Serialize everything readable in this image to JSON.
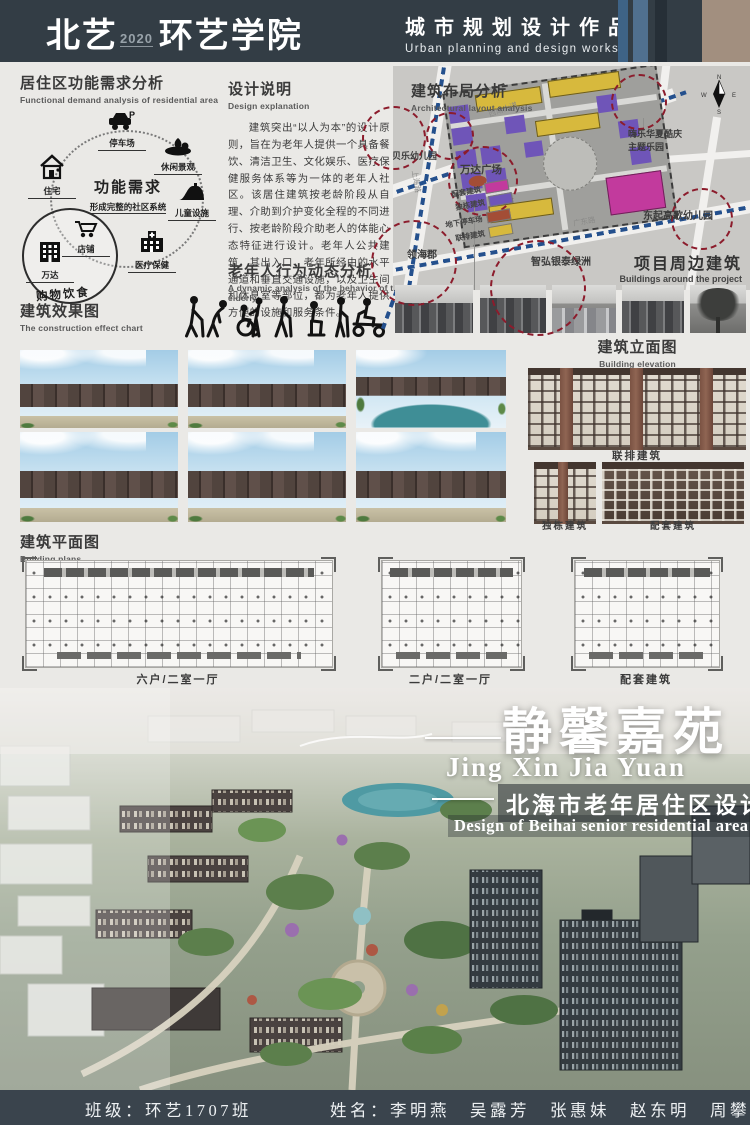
{
  "header": {
    "brand": "北艺",
    "year": "2020",
    "school": "环艺学院",
    "title_cn": "城市规划设计作品",
    "title_en": "Urban planning and design works"
  },
  "demand": {
    "title_cn": "居住区功能需求分析",
    "title_en": "Functional demand analysis of residential area",
    "center": "功能需求",
    "center_sub": "形成完整的社区系统",
    "nodes": [
      "停车场",
      "休闲景观",
      "儿童设施",
      "医疗保健",
      "住宅"
    ],
    "shop": {
      "title": "购物饮食",
      "wanda": "万达",
      "store": "店铺"
    }
  },
  "design": {
    "title_cn": "设计说明",
    "title_en": "Design explanation",
    "body": "建筑突出“以人为本”的设计原则，旨在为老年人提供一个具备餐饮、清洁卫生、文化娱乐、医疗保健服务体系等为一体的老年人社区。该居住建筑按老龄阶段从自理、介助到介护变化全程的不同进行、按老龄阶段介助老人的体能心态特征进行设计。老年人公共建筑，其出入口、老年所经由的水平通道和垂直交通设施，以及卫生间和休息室等部位，都为老年人提供方便的设施和服务条件。"
  },
  "elderly": {
    "title_cn": "老年人行为动态分析",
    "title_en": "A dynamic analysis of the behavior of the elderly"
  },
  "layout": {
    "title_cn": "建筑布局分析",
    "title_en": "Architectural layout analysis",
    "legend": [
      {
        "label": "配套建筑",
        "color": "#c23a9d"
      },
      {
        "label": "独栋建筑",
        "color": "#6f55b8"
      },
      {
        "label": "地下停车场",
        "color": "#a34d36"
      },
      {
        "label": "联排建筑",
        "color": "#d7b93d"
      }
    ],
    "labels": {
      "kindergarten": "贝乐幼儿园",
      "wanda": "万达广场",
      "linghai": "领海郡",
      "zhihong": "智弘银泰绿洲",
      "dongqi": "东起高歌幼儿园",
      "theme_park_1": "嗨乐华夏酷庆",
      "theme_park_2": "主题乐园",
      "road_top": "西南大道",
      "road_left": "上海路",
      "road_bottom": "广东路"
    },
    "surround_cn": "项目周边建筑",
    "surround_en": "Buildings around the project",
    "compass": {
      "n": "N",
      "w": "W",
      "e": "E",
      "s": "S"
    }
  },
  "effect": {
    "title_cn": "建筑效果图",
    "title_en": "The construction effect chart"
  },
  "elevation": {
    "title_cn": "建筑立面图",
    "title_en": "Building elevation",
    "label_row": "联排建筑",
    "label_single": "独栋建筑",
    "label_support": "配套建筑"
  },
  "plans": {
    "title_cn": "建筑平面图",
    "title_en": "Building plans",
    "label_1": "六户/二室一厅",
    "label_2": "二户/二室一厅",
    "label_3": "配套建筑"
  },
  "hero": {
    "title": "静馨嘉苑",
    "pinyin": "Jing Xin Jia Yuan",
    "sub_cn": "北海市老年居住区设计",
    "sub_en": "Design of Beihai senior residential area"
  },
  "footer": {
    "class_label": "班级：环艺1707班",
    "names_label": "姓名：李明燕　吴露芳　张惠妹　赵东明　周攀东"
  }
}
